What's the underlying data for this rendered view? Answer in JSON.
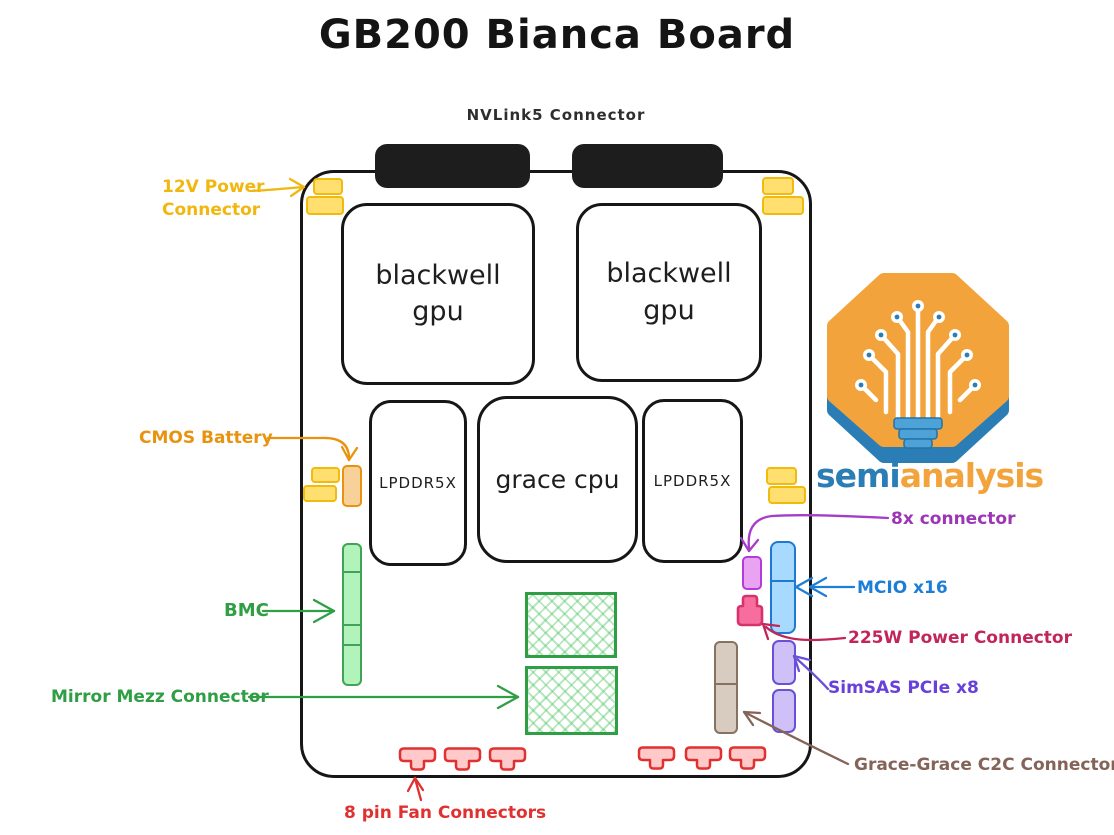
{
  "title": "GB200 Bianca Board",
  "board": {
    "nvlink_connector_label": "NVLink5 Connector",
    "gpu_left": "blackwell gpu",
    "gpu_right": "blackwell gpu",
    "lpddr_left": "LPDDR5X",
    "cpu": "grace cpu",
    "lpddr_right": "LPDDR5X"
  },
  "callouts": {
    "power_12v_line1": "12V Power",
    "power_12v_line2": "Connector",
    "cmos_battery": "CMOS Battery",
    "bmc": "BMC",
    "mirror_mezz": "Mirror Mezz Connector",
    "fan_connectors": "8 pin Fan Connectors",
    "connector_8x": "8x connector",
    "mcio": "MCIO x16",
    "power_225w": "225W Power Connector",
    "simsas": "SimSAS PCIe x8",
    "c2c": "Grace-Grace C2C Connector"
  },
  "logo": {
    "brand_part1": "semi",
    "brand_part2": "analysis"
  },
  "colors": {
    "callout_yellow": "#f1b70e",
    "callout_orange": "#e8930f",
    "callout_green": "#2f9e44",
    "callout_red": "#e03131",
    "callout_purple": "#9c36b5",
    "callout_blue": "#1c7ed6",
    "callout_crimson": "#c2255c",
    "callout_violet": "#6741d9",
    "callout_brown": "#846358",
    "logo_blue": "#2a7db5",
    "logo_orange": "#f2a33c"
  }
}
